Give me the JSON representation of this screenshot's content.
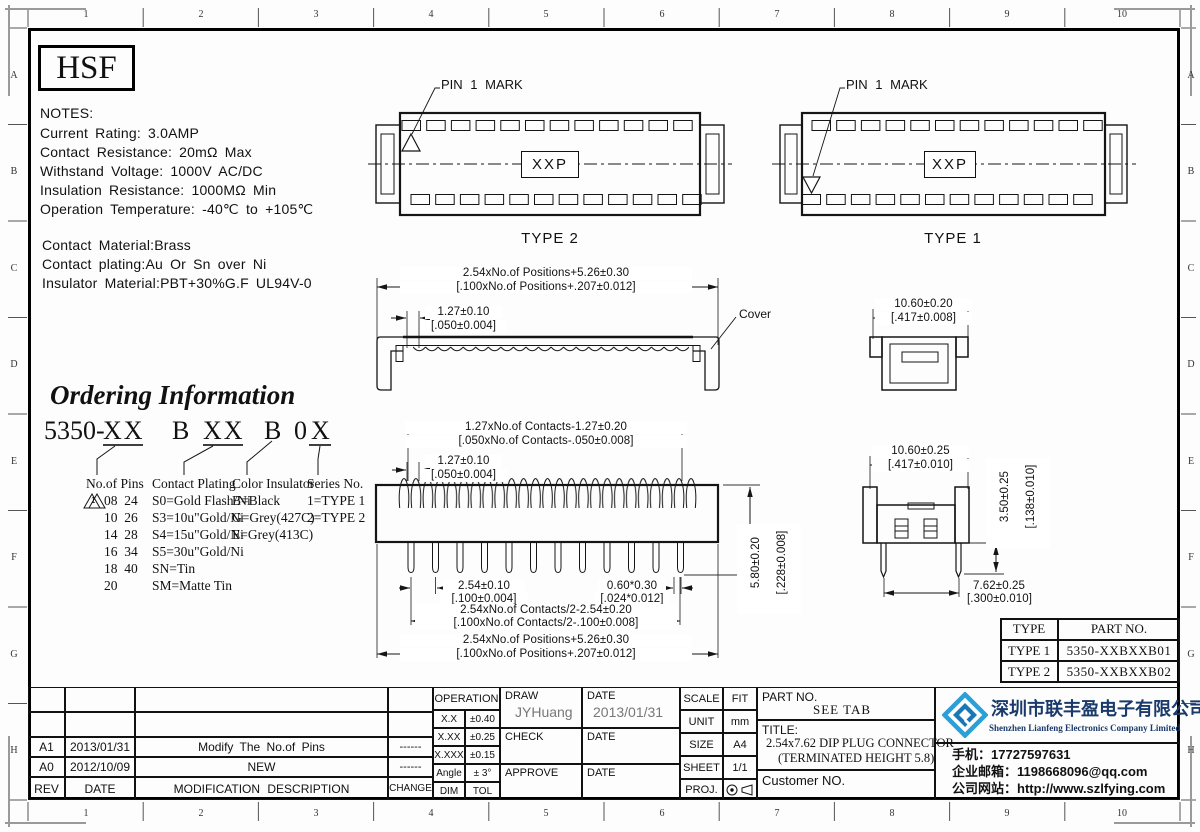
{
  "frame": {
    "cols": [
      "1",
      "2",
      "3",
      "4",
      "5",
      "6",
      "7",
      "8",
      "9",
      "10"
    ],
    "rows": [
      "A",
      "B",
      "C",
      "D",
      "E",
      "F",
      "G",
      "H"
    ]
  },
  "logo_text": "HSF",
  "notes": {
    "title": "NOTES:",
    "lines": [
      "Current Rating: 3.0AMP",
      "Contact Resistance: 20mΩ Max",
      "Withstand Voltage: 1000V AC/DC",
      "Insulation Resistance: 1000MΩ Min",
      "Operation Temperature: -40℃ to +105℃"
    ],
    "materials": [
      "Contact Material:Brass",
      "Contact plating:Au Or Sn over Ni",
      "Insulator Material:PBT+30%G.F UL94V-0"
    ]
  },
  "top_views": {
    "pin1_mark": "PIN 1 MARK",
    "xxp": "XXP",
    "type2": "TYPE 2",
    "type1": "TYPE 1"
  },
  "dims": {
    "positions_mm": "2.54xNo.of Positions+5.26±0.30",
    "positions_in": "[.100xNo.of Positions+.207±0.012]",
    "pitch_small_mm": "1.27±0.10",
    "pitch_small_in": "[.050±0.004]",
    "cover_label": "Cover",
    "contacts_mm": "1.27xNo.of Contacts-1.27±0.20",
    "contacts_in": "[.050xNo.of Contacts-.050±0.008]",
    "pin_pitch_mm": "2.54±0.10",
    "pin_pitch_in": "[.100±0.004]",
    "pin_w_mm": "0.60*0.30",
    "pin_w_in": "[.024*0.012]",
    "half_mm": "2.54xNo.of Contacts/2-2.54±0.20",
    "half_in": "[.100xNo.of Contacts/2-.100±0.008]",
    "height_mm": "5.80±0.20",
    "height_in": "[.228±0.008]",
    "cover_w_mm": "10.60±0.20",
    "cover_w_in": "[.417±0.008]",
    "body_w_mm": "10.60±0.25",
    "body_w_in": "[.417±0.010]",
    "body_h_mm": "3.50±0.25",
    "body_h_in": "[.138±0.010]",
    "row_mm": "7.62±0.25",
    "row_in": "[.300±0.010]"
  },
  "ordering": {
    "title": "Ordering Information",
    "prefix": "5350-",
    "seg1": "XX",
    "seg2": "B",
    "seg3": "XX",
    "seg4": "B",
    "seg5": "0",
    "seg6": "X",
    "rev_flag": "1",
    "col_pins": {
      "header": "No.of Pins",
      "items": [
        "08  24",
        "10  26",
        "14  28",
        "16  34",
        "18  40",
        "20"
      ]
    },
    "col_plating": {
      "header": "Contact Plating",
      "items": [
        "S0=Gold Flash/Ni",
        "S3=10u\"Gold/Ni",
        "S4=15u\"Gold/Ni",
        "S5=30u\"Gold/Ni",
        "SN=Tin",
        "SM=Matte Tin"
      ]
    },
    "col_color": {
      "header": "Color Insulator",
      "items": [
        "B=Black",
        "G=Grey(427C)",
        "E=Grey(413C)"
      ]
    },
    "col_series": {
      "header": "Series No.",
      "items": [
        "1=TYPE 1",
        "2=TYPE 2"
      ]
    }
  },
  "type_table": {
    "h1": "TYPE",
    "h2": "PART NO.",
    "rows": [
      [
        "TYPE 1",
        "5350-XXBXXB01"
      ],
      [
        "TYPE 2",
        "5350-XXBXXB02"
      ]
    ]
  },
  "revisions": {
    "headers": [
      "REV",
      "DATE",
      "MODIFICATION DESCRIPTION",
      "CHANGE"
    ],
    "rows": [
      [
        "A1",
        "2013/01/31",
        "Modify The No.of Pins",
        "------"
      ],
      [
        "A0",
        "2012/10/09",
        "NEW",
        "------"
      ]
    ]
  },
  "tolerance": {
    "header": "OPERATION",
    "rows": [
      [
        "X.X",
        "±0.40"
      ],
      [
        "X.XX",
        "±0.25"
      ],
      [
        "X.XXX",
        "±0.15"
      ],
      [
        "Angle",
        "± 3°"
      ],
      [
        "DIM",
        "TOL"
      ]
    ]
  },
  "sign": {
    "draw_label": "DRAW",
    "draw_name": "JYHuang",
    "date_label": "DATE",
    "draw_date": "2013/01/31",
    "check_label": "CHECK",
    "approve_label": "APPROVE"
  },
  "info": {
    "scale_label": "SCALE",
    "scale": "FIT",
    "unit_label": "UNIT",
    "unit": "mm",
    "size_label": "SIZE",
    "size": "A4",
    "sheet_label": "SHEET",
    "sheet": "1/1",
    "proj_label": "PROJ."
  },
  "title_block": {
    "part_label": "PART NO.",
    "part_value": "SEE TAB",
    "title_label": "TITLE:",
    "title_line1": "2.54x7.62 DIP PLUG CONNECTOR",
    "title_line2": "(TERMINATED HEIGHT 5.8)",
    "customer": "Customer NO."
  },
  "company": {
    "name_cn": "深圳市联丰盈电子有限公司",
    "name_en": "Shenzhen Lianfeng Electronics Company Limited",
    "phone": "手机：17727597631",
    "email": "企业邮箱：1198668096@qq.com",
    "website": "公司网站：http://www.szlfying.com",
    "brand_blue": "#2b9fd8",
    "navy": "#1a3a6b"
  }
}
